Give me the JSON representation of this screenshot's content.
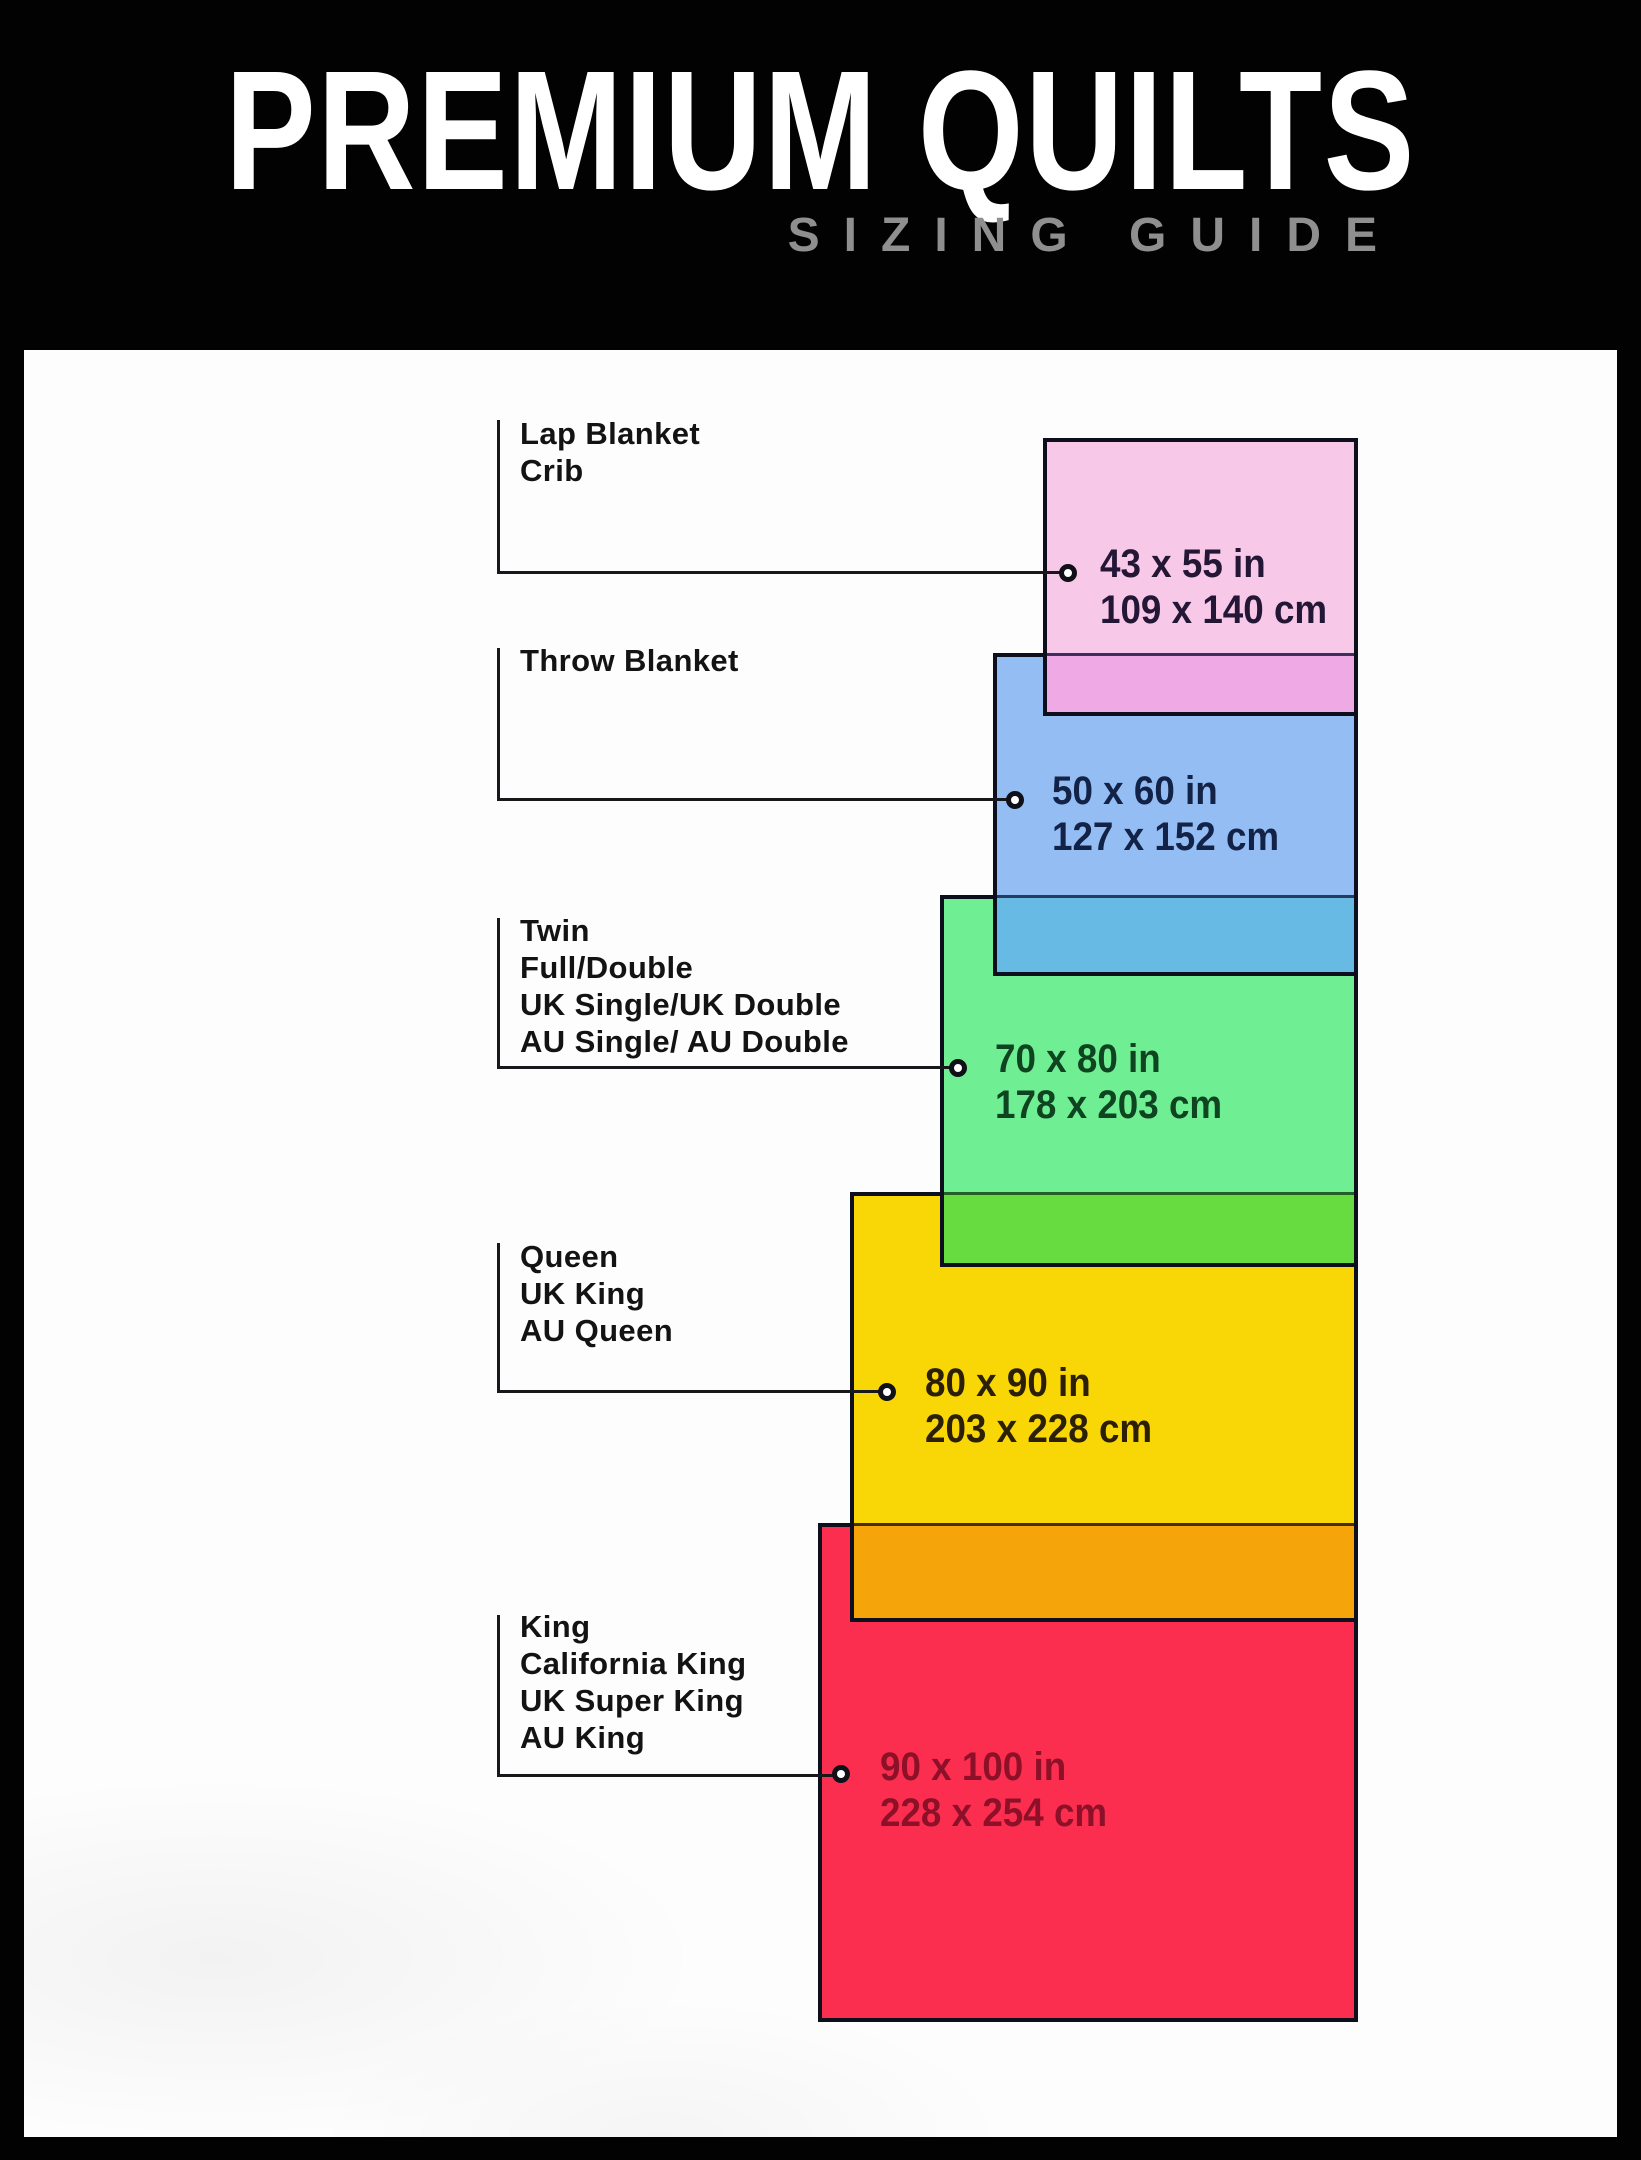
{
  "header": {
    "title": "PREMIUM QUILTS",
    "subtitle": "SIZING GUIDE",
    "bg": "#000000",
    "title_color": "#ffffff",
    "subtitle_color": "#8f8f8f"
  },
  "canvas": {
    "panel_bg": "#fdfdfd",
    "line_color": "#17171c",
    "rect_border_color": "#0d0f1c"
  },
  "sizes": [
    {
      "id": "lap-crib",
      "names": [
        "Lap Blanket",
        "Crib"
      ],
      "inches": "43 x 55 in",
      "cm": "109 x 140 cm",
      "fill": "#f8c8e8",
      "overlap_with_next": "#efa9e4",
      "text_color": "#241736"
    },
    {
      "id": "throw",
      "names": [
        "Throw Blanket"
      ],
      "inches": "50 x 60 in",
      "cm": "127 x 152 cm",
      "fill": "#94bef3",
      "overlap_with_next": "#66bae3",
      "text_color": "#132247"
    },
    {
      "id": "twin-full-double",
      "names": [
        "Twin",
        "Full/Double",
        "UK Single/UK Double",
        "AU Single/ AU Double"
      ],
      "inches": "70 x 80 in",
      "cm": "178 x 203 cm",
      "fill": "#70ee93",
      "overlap_with_next": "#67dc40",
      "text_color": "#0e4420"
    },
    {
      "id": "queen",
      "names": [
        "Queen",
        "UK King",
        "AU Queen"
      ],
      "inches": "80 x 90 in",
      "cm": "203 x 228 cm",
      "fill": "#f9d606",
      "overlap_with_next": "#f5a50a",
      "text_color": "#2b2005"
    },
    {
      "id": "king",
      "names": [
        "King",
        "California King",
        "UK Super King",
        "AU King"
      ],
      "inches": "90 x 100 in",
      "cm": "228 x 254 cm",
      "fill": "#fc2e50",
      "text_color": "#8c1128"
    }
  ]
}
